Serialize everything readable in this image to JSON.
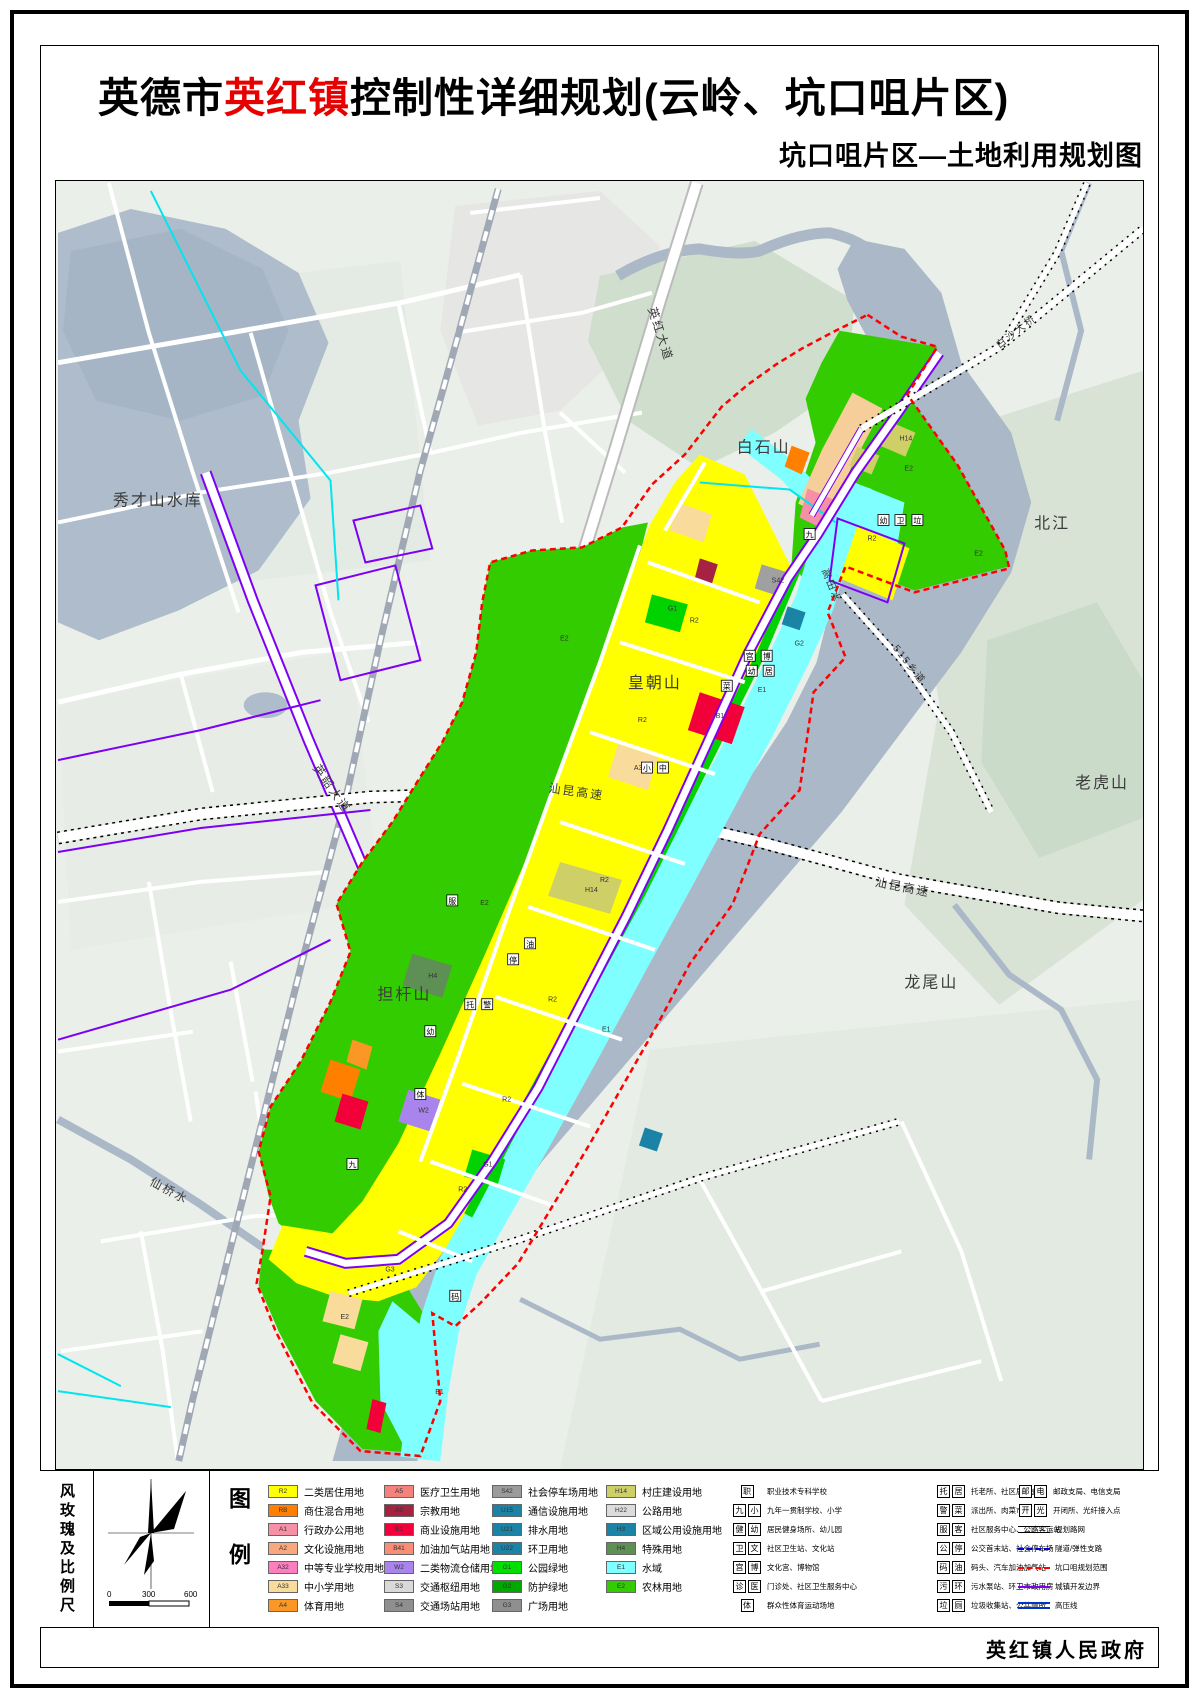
{
  "title": {
    "prefix": "英德市",
    "highlight": "英红镇",
    "suffix": "控制性详细规划(云岭、坑口咀片区)",
    "subtitle": "坑口咀片区—土地利用规划图"
  },
  "footer": {
    "publisher": "英红镇人民政府"
  },
  "legend": {
    "panel_label": "图例",
    "sidebar_label": "风玫瑰及比例尺",
    "scale_ticks": [
      "0",
      "300",
      "600"
    ],
    "color_columns": [
      [
        {
          "code": "R2",
          "color": "#FFFF00",
          "label": "二类居住用地"
        },
        {
          "code": "RB",
          "color": "#FF8000",
          "label": "商住混合用地"
        },
        {
          "code": "A1",
          "color": "#F590A6",
          "label": "行政办公用地"
        },
        {
          "code": "A2",
          "color": "#F9A87E",
          "label": "文化设施用地"
        },
        {
          "code": "A32",
          "color": "#FC7EBE",
          "label": "中等专业学校用地"
        },
        {
          "code": "A33",
          "color": "#F9DB9B",
          "label": "中小学用地"
        },
        {
          "code": "A4",
          "color": "#FB9724",
          "label": "体育用地"
        }
      ],
      [
        {
          "code": "A5",
          "color": "#F4837D",
          "label": "医疗卫生用地"
        },
        {
          "code": "A9",
          "color": "#A52242",
          "label": "宗教用地"
        },
        {
          "code": "B1",
          "color": "#F20039",
          "label": "商业设施用地"
        },
        {
          "code": "B41",
          "color": "#F98D76",
          "label": "加油加气站用地"
        },
        {
          "code": "W2",
          "color": "#A984EC",
          "label": "二类物流仓储用地"
        },
        {
          "code": "S3",
          "color": "#D9D9D9",
          "label": "交通枢纽用地"
        },
        {
          "code": "S4",
          "color": "#8F8F8F",
          "label": "交通场站用地"
        }
      ],
      [
        {
          "code": "S42",
          "color": "#9B9B9B",
          "label": "社会停车场用地"
        },
        {
          "code": "U15",
          "color": "#1B84A6",
          "label": "通信设施用地"
        },
        {
          "code": "U21",
          "color": "#1B84A6",
          "label": "排水用地"
        },
        {
          "code": "U22",
          "color": "#1B84A6",
          "label": "环卫用地"
        },
        {
          "code": "G1",
          "color": "#00E000",
          "label": "公园绿地"
        },
        {
          "code": "G2",
          "color": "#00A800",
          "label": "防护绿地"
        },
        {
          "code": "G3",
          "color": "#8F8F8F",
          "label": "广场用地"
        }
      ],
      [
        {
          "code": "H14",
          "color": "#CFCF68",
          "label": "村庄建设用地"
        },
        {
          "code": "H22",
          "color": "#DCDCDC",
          "label": "公路用地"
        },
        {
          "code": "H3",
          "color": "#1B84A6",
          "label": "区域公用设施用地"
        },
        {
          "code": "H4",
          "color": "#5E8F54",
          "label": "特殊用地"
        },
        {
          "code": "E1",
          "color": "#7FFFFF",
          "label": "水域"
        },
        {
          "code": "E2",
          "color": "#33CC00",
          "label": "农林用地"
        }
      ]
    ],
    "icon_columns": [
      [
        {
          "icons": [
            "职"
          ],
          "label": "职业技术专科学校"
        },
        {
          "icons": [
            "九",
            "小"
          ],
          "label": "九年一贯制学校、小学"
        },
        {
          "icons": [
            "健",
            "幼"
          ],
          "label": "居民健身场所、幼儿园"
        },
        {
          "icons": [
            "卫",
            "文"
          ],
          "label": "社区卫生站、文化站"
        },
        {
          "icons": [
            "宫",
            "博"
          ],
          "label": "文化宫、博物馆"
        },
        {
          "icons": [
            "诊",
            "医"
          ],
          "label": "门诊处、社区卫生服务中心"
        },
        {
          "icons": [
            "体"
          ],
          "label": "群众性体育运动场地"
        }
      ],
      [
        {
          "icons": [
            "托",
            "居"
          ],
          "label": "托老所、社区居委会"
        },
        {
          "icons": [
            "警",
            "菜"
          ],
          "label": "派出所、肉菜市场"
        },
        {
          "icons": [
            "服",
            "客"
          ],
          "label": "社区服务中心、公路客运站"
        },
        {
          "icons": [
            "公",
            "停"
          ],
          "label": "公交首末站、社会停车场"
        },
        {
          "icons": [
            "码",
            "油"
          ],
          "label": "码头、汽车加油加气站"
        },
        {
          "icons": [
            "污",
            "环"
          ],
          "label": "污水泵站、环卫市政用房"
        },
        {
          "icons": [
            "垃",
            "厕"
          ],
          "label": "垃圾收集站、公共厕所"
        }
      ]
    ],
    "line_column": [
      {
        "icons": [
          "邮",
          "电"
        ],
        "label": "邮政支局、电信支局"
      },
      {
        "icons": [
          "开",
          "光"
        ],
        "label": "开闭所、光纤接入点"
      },
      {
        "line": "road",
        "label": "规划路网"
      },
      {
        "line": "tunnel",
        "label": "隧道/弹性支路"
      },
      {
        "line": "range",
        "label": "坑口咀规划范围"
      },
      {
        "line": "urban",
        "label": "城镇开发边界"
      },
      {
        "line": "hv",
        "label": "高压线"
      }
    ]
  },
  "map": {
    "labels": [
      {
        "text": "秀才山水库",
        "x": 112,
        "y": 505,
        "size": 16,
        "rot": 0
      },
      {
        "text": "白石山",
        "x": 737,
        "y": 452,
        "size": 16,
        "rot": 0
      },
      {
        "text": "北江",
        "x": 1035,
        "y": 528,
        "size": 16,
        "rot": 0
      },
      {
        "text": "皇朝山",
        "x": 628,
        "y": 688,
        "size": 16,
        "rot": 0
      },
      {
        "text": "老虎山",
        "x": 1076,
        "y": 788,
        "size": 16,
        "rot": 0
      },
      {
        "text": "龙尾山",
        "x": 905,
        "y": 988,
        "size": 16,
        "rot": 0
      },
      {
        "text": "担杆山",
        "x": 377,
        "y": 1000,
        "size": 16,
        "rot": 0
      },
      {
        "text": "仙桥水",
        "x": 148,
        "y": 1185,
        "size": 12,
        "rot": 28
      },
      {
        "text": "英红大道",
        "x": 648,
        "y": 308,
        "size": 12,
        "rot": 72
      },
      {
        "text": "英韶大道",
        "x": 312,
        "y": 768,
        "size": 12,
        "rot": 55
      },
      {
        "text": "汕昆高速",
        "x": 548,
        "y": 792,
        "size": 12,
        "rot": 8
      },
      {
        "text": "汕昆高速",
        "x": 875,
        "y": 886,
        "size": 12,
        "rot": 11
      },
      {
        "text": "515乡道",
        "x": 893,
        "y": 648,
        "size": 10,
        "rot": 52
      },
      {
        "text": "白沙大桥",
        "x": 1000,
        "y": 348,
        "size": 10,
        "rot": -38
      },
      {
        "text": "高田水",
        "x": 822,
        "y": 570,
        "size": 10,
        "rot": 68
      }
    ],
    "parcel_codes": [
      {
        "t": "E2",
        "x": 560,
        "y": 640
      },
      {
        "t": "E2",
        "x": 905,
        "y": 470
      },
      {
        "t": "E2",
        "x": 975,
        "y": 555
      },
      {
        "t": "E2",
        "x": 480,
        "y": 905
      },
      {
        "t": "E2",
        "x": 340,
        "y": 1320
      },
      {
        "t": "R2",
        "x": 690,
        "y": 622
      },
      {
        "t": "R2",
        "x": 638,
        "y": 722
      },
      {
        "t": "R2",
        "x": 600,
        "y": 882
      },
      {
        "t": "R2",
        "x": 548,
        "y": 1002
      },
      {
        "t": "R2",
        "x": 502,
        "y": 1102
      },
      {
        "t": "R2",
        "x": 458,
        "y": 1192
      },
      {
        "t": "R2",
        "x": 868,
        "y": 540
      },
      {
        "t": "G1",
        "x": 668,
        "y": 610
      },
      {
        "t": "G1",
        "x": 483,
        "y": 1167
      },
      {
        "t": "G2",
        "x": 795,
        "y": 645
      },
      {
        "t": "E1",
        "x": 758,
        "y": 692
      },
      {
        "t": "E1",
        "x": 602,
        "y": 1032
      },
      {
        "t": "E1",
        "x": 435,
        "y": 1395
      },
      {
        "t": "H14",
        "x": 900,
        "y": 440
      },
      {
        "t": "H14",
        "x": 585,
        "y": 892
      },
      {
        "t": "B1",
        "x": 716,
        "y": 718
      },
      {
        "t": "W2",
        "x": 418,
        "y": 1113
      },
      {
        "t": "A33",
        "x": 634,
        "y": 770
      },
      {
        "t": "H4",
        "x": 428,
        "y": 978
      },
      {
        "t": "S42",
        "x": 772,
        "y": 582
      },
      {
        "t": "G3",
        "x": 385,
        "y": 1272
      }
    ],
    "icon_marks": [
      {
        "t": "九",
        "x": 810,
        "y": 537
      },
      {
        "t": "小",
        "x": 647,
        "y": 771
      },
      {
        "t": "中",
        "x": 663,
        "y": 771
      },
      {
        "t": "幼",
        "x": 884,
        "y": 523
      },
      {
        "t": "卫",
        "x": 901,
        "y": 523
      },
      {
        "t": "垃",
        "x": 918,
        "y": 523
      },
      {
        "t": "菜",
        "x": 727,
        "y": 689
      },
      {
        "t": "宫",
        "x": 750,
        "y": 659
      },
      {
        "t": "博",
        "x": 767,
        "y": 659
      },
      {
        "t": "幼",
        "x": 752,
        "y": 674
      },
      {
        "t": "居",
        "x": 769,
        "y": 674
      },
      {
        "t": "服",
        "x": 452,
        "y": 904
      },
      {
        "t": "油",
        "x": 530,
        "y": 947
      },
      {
        "t": "停",
        "x": 513,
        "y": 963
      },
      {
        "t": "九",
        "x": 352,
        "y": 1168
      },
      {
        "t": "幼",
        "x": 430,
        "y": 1035
      },
      {
        "t": "托",
        "x": 470,
        "y": 1008
      },
      {
        "t": "警",
        "x": 487,
        "y": 1008
      },
      {
        "t": "体",
        "x": 420,
        "y": 1098
      },
      {
        "t": "码",
        "x": 455,
        "y": 1300
      }
    ],
    "colors": {
      "residential": "#FFFF00",
      "park_green": "#00E000",
      "farm_green": "#33CC00",
      "water_plan": "#7FFFFF",
      "river": "#ABB8C7",
      "boundary_red": "#FF0000",
      "urban_purple": "#7D00F5",
      "commercial_red": "#F20039"
    }
  }
}
